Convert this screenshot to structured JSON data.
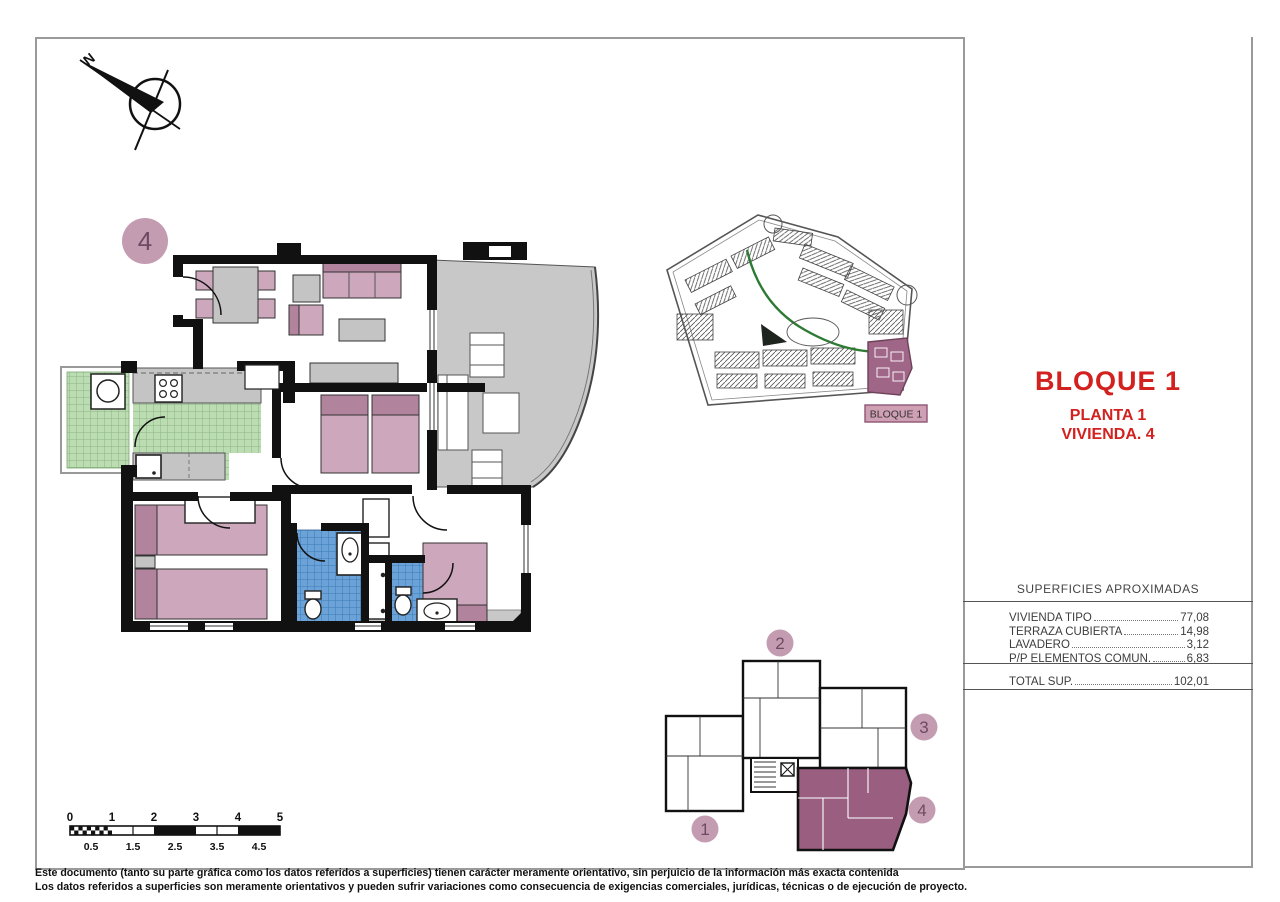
{
  "titles": {
    "bloque": "BLOQUE 1",
    "planta": "PLANTA 1",
    "vivienda": "VIVIENDA. 4"
  },
  "surfaces": {
    "title": "SUPERFICIES APROXIMADAS",
    "rows": [
      {
        "label": "VIVIENDA TIPO",
        "value": "77,08"
      },
      {
        "label": "TERRAZA CUBIERTA",
        "value": "14,98"
      },
      {
        "label": "LAVADERO",
        "value": "3,12"
      },
      {
        "label": "P/P ELEMENTOS COMUN.",
        "value": "6,83"
      }
    ],
    "total_label": "TOTAL SUP.",
    "total_value": "102,01"
  },
  "main_plan": {
    "unit_badge": "4"
  },
  "site_plan": {
    "highlight_label": "BLOQUE 1"
  },
  "key_plan": {
    "unit_1": "1",
    "unit_2": "2",
    "unit_3": "3",
    "unit_4": "4"
  },
  "compass": {
    "north_label": "N"
  },
  "scale_bar": {
    "top": [
      "0",
      "1",
      "2",
      "3",
      "4",
      "5"
    ],
    "bottom": [
      "0.5",
      "1.5",
      "2.5",
      "3.5",
      "4.5"
    ]
  },
  "disclaimer": {
    "line1": "Este documento (tanto su parte gráfica como los datos referidos a superficies) tienen carácter meramente orientativo, sin perjuicio de la información más exacta contenida",
    "line2": "Los datos referidos a superficies son meramente orientativos y pueden sufrir variaciones como consecuencia de exigencias comerciales, jurídicas, técnicas o de ejecución de proyecto."
  },
  "colors": {
    "accent_red": "#d2211f",
    "mauve_badge": "#c49cb2",
    "mauve_badge_text": "#6e4a62",
    "unit_highlight": "#9a5f80",
    "site_highlight": "#a06687",
    "label_box_fill": "#cf9fb4",
    "label_box_border": "#8d5675",
    "furniture_pink": "#cda7bc",
    "furniture_pink_dark": "#b2839c",
    "tile_green": "#bcdcb2",
    "tile_blue": "#6ba3d8",
    "terrace_gray": "#c8c8c8",
    "wall_black": "#111111",
    "path_green": "#2d7a33"
  }
}
